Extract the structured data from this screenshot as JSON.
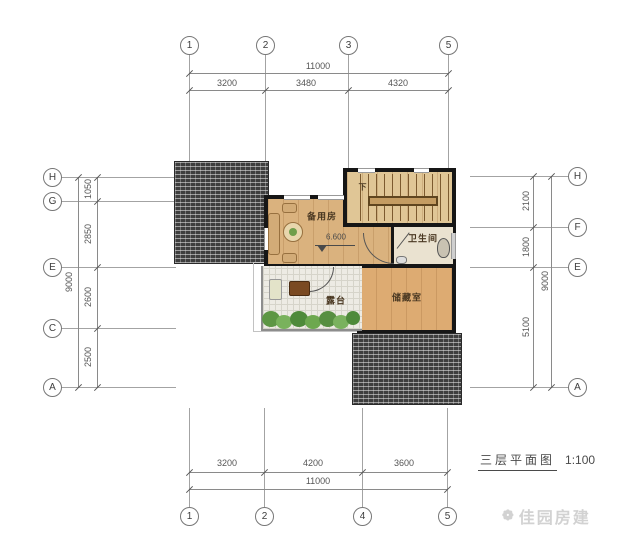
{
  "drawing": {
    "title": "三层平面图",
    "scale": "1:100",
    "watermark": "佳园房建"
  },
  "grid": {
    "top": {
      "bubbles": [
        "1",
        "2",
        "3",
        "5"
      ],
      "overall": "11000",
      "segments": [
        "3200",
        "3480",
        "4320"
      ]
    },
    "bottom": {
      "bubbles": [
        "1",
        "2",
        "4",
        "5"
      ],
      "overall": "11000",
      "segments": [
        "3200",
        "4200",
        "3600"
      ]
    },
    "left": {
      "bubbles": [
        "H",
        "G",
        "E",
        "C",
        "A"
      ],
      "overall": "9000",
      "segments": [
        "1050",
        "2850",
        "2600",
        "2500"
      ]
    },
    "right": {
      "bubbles": [
        "H",
        "F",
        "E",
        "A"
      ],
      "overall": "9000",
      "segments": [
        "2100",
        "1800",
        "5100"
      ]
    }
  },
  "plan": {
    "rooms": [
      {
        "label": "备用房"
      },
      {
        "label": "卫生间"
      },
      {
        "label": "露台"
      },
      {
        "label": "储藏室"
      }
    ],
    "stair_direction": "下",
    "level_mark": "6.600"
  },
  "colors": {
    "wall": "#161616",
    "wood_floor": "#dab27e",
    "roof_tile": "#3e3e3e",
    "terrace_floor": "#edebe4",
    "plant_green": "#5d9644"
  }
}
